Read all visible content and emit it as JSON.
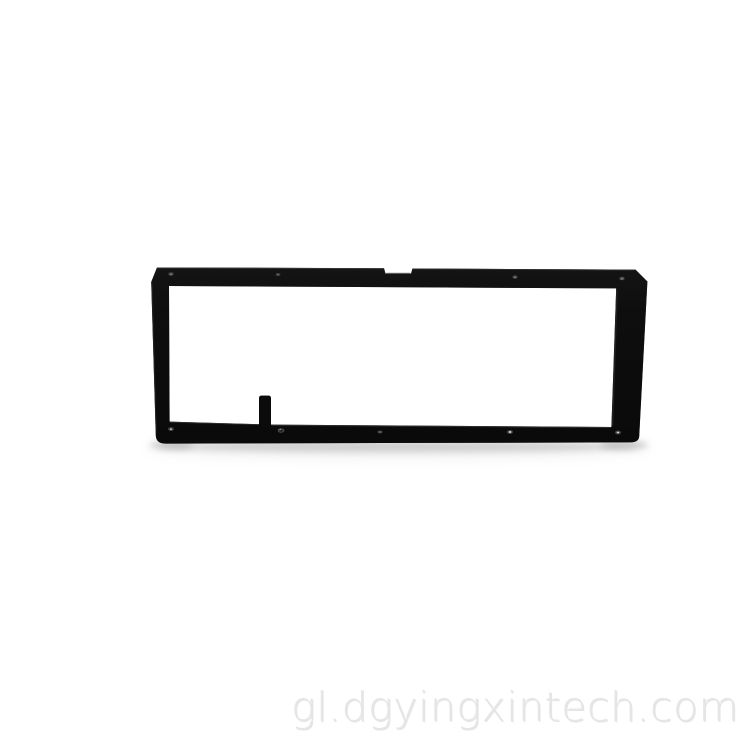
{
  "photo": {
    "subject": "Black rectangular machined metal frame bracket on white studio background",
    "background_color": "#ffffff",
    "frame_color": "#0e0e0e",
    "shadow_color": "#b5b5b5",
    "screw_holes_top": 4,
    "screw_holes_bottom": 5,
    "notch": "small rectangular notch on top edge",
    "tab": "small vertical tab rising from inner bottom rail"
  },
  "watermark": {
    "text": "gl.dgyingxintech.com",
    "color": "#e5e5e5"
  }
}
